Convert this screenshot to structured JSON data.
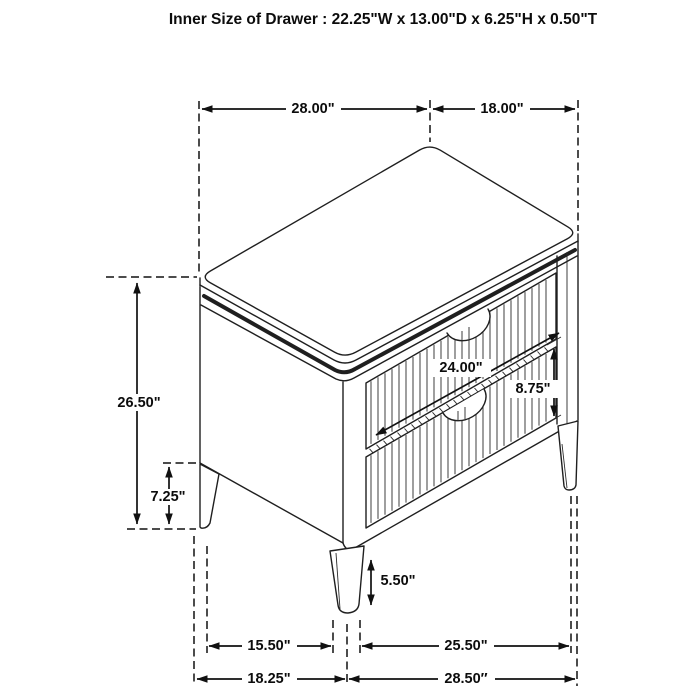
{
  "title": "Inner Size of Drawer : 22.25\"W x 13.00\"D x 6.25\"H x 0.50\"T",
  "colors": {
    "line": "#1f1f1f",
    "background": "#ffffff"
  },
  "dims": {
    "top_width": "28.00\"",
    "top_depth": "18.00\"",
    "overall_height": "26.50\"",
    "base_clearance_height": "7.25\"",
    "drawer_face_width": "24.00\"",
    "drawer_section_height": "8.75\"",
    "front_leg_height": "5.50\"",
    "leg_span_depth": "15.50\"",
    "leg_span_width": "25.50\"",
    "floor_depth_overall": "18.25\"",
    "floor_width_overall": "28.50″"
  }
}
